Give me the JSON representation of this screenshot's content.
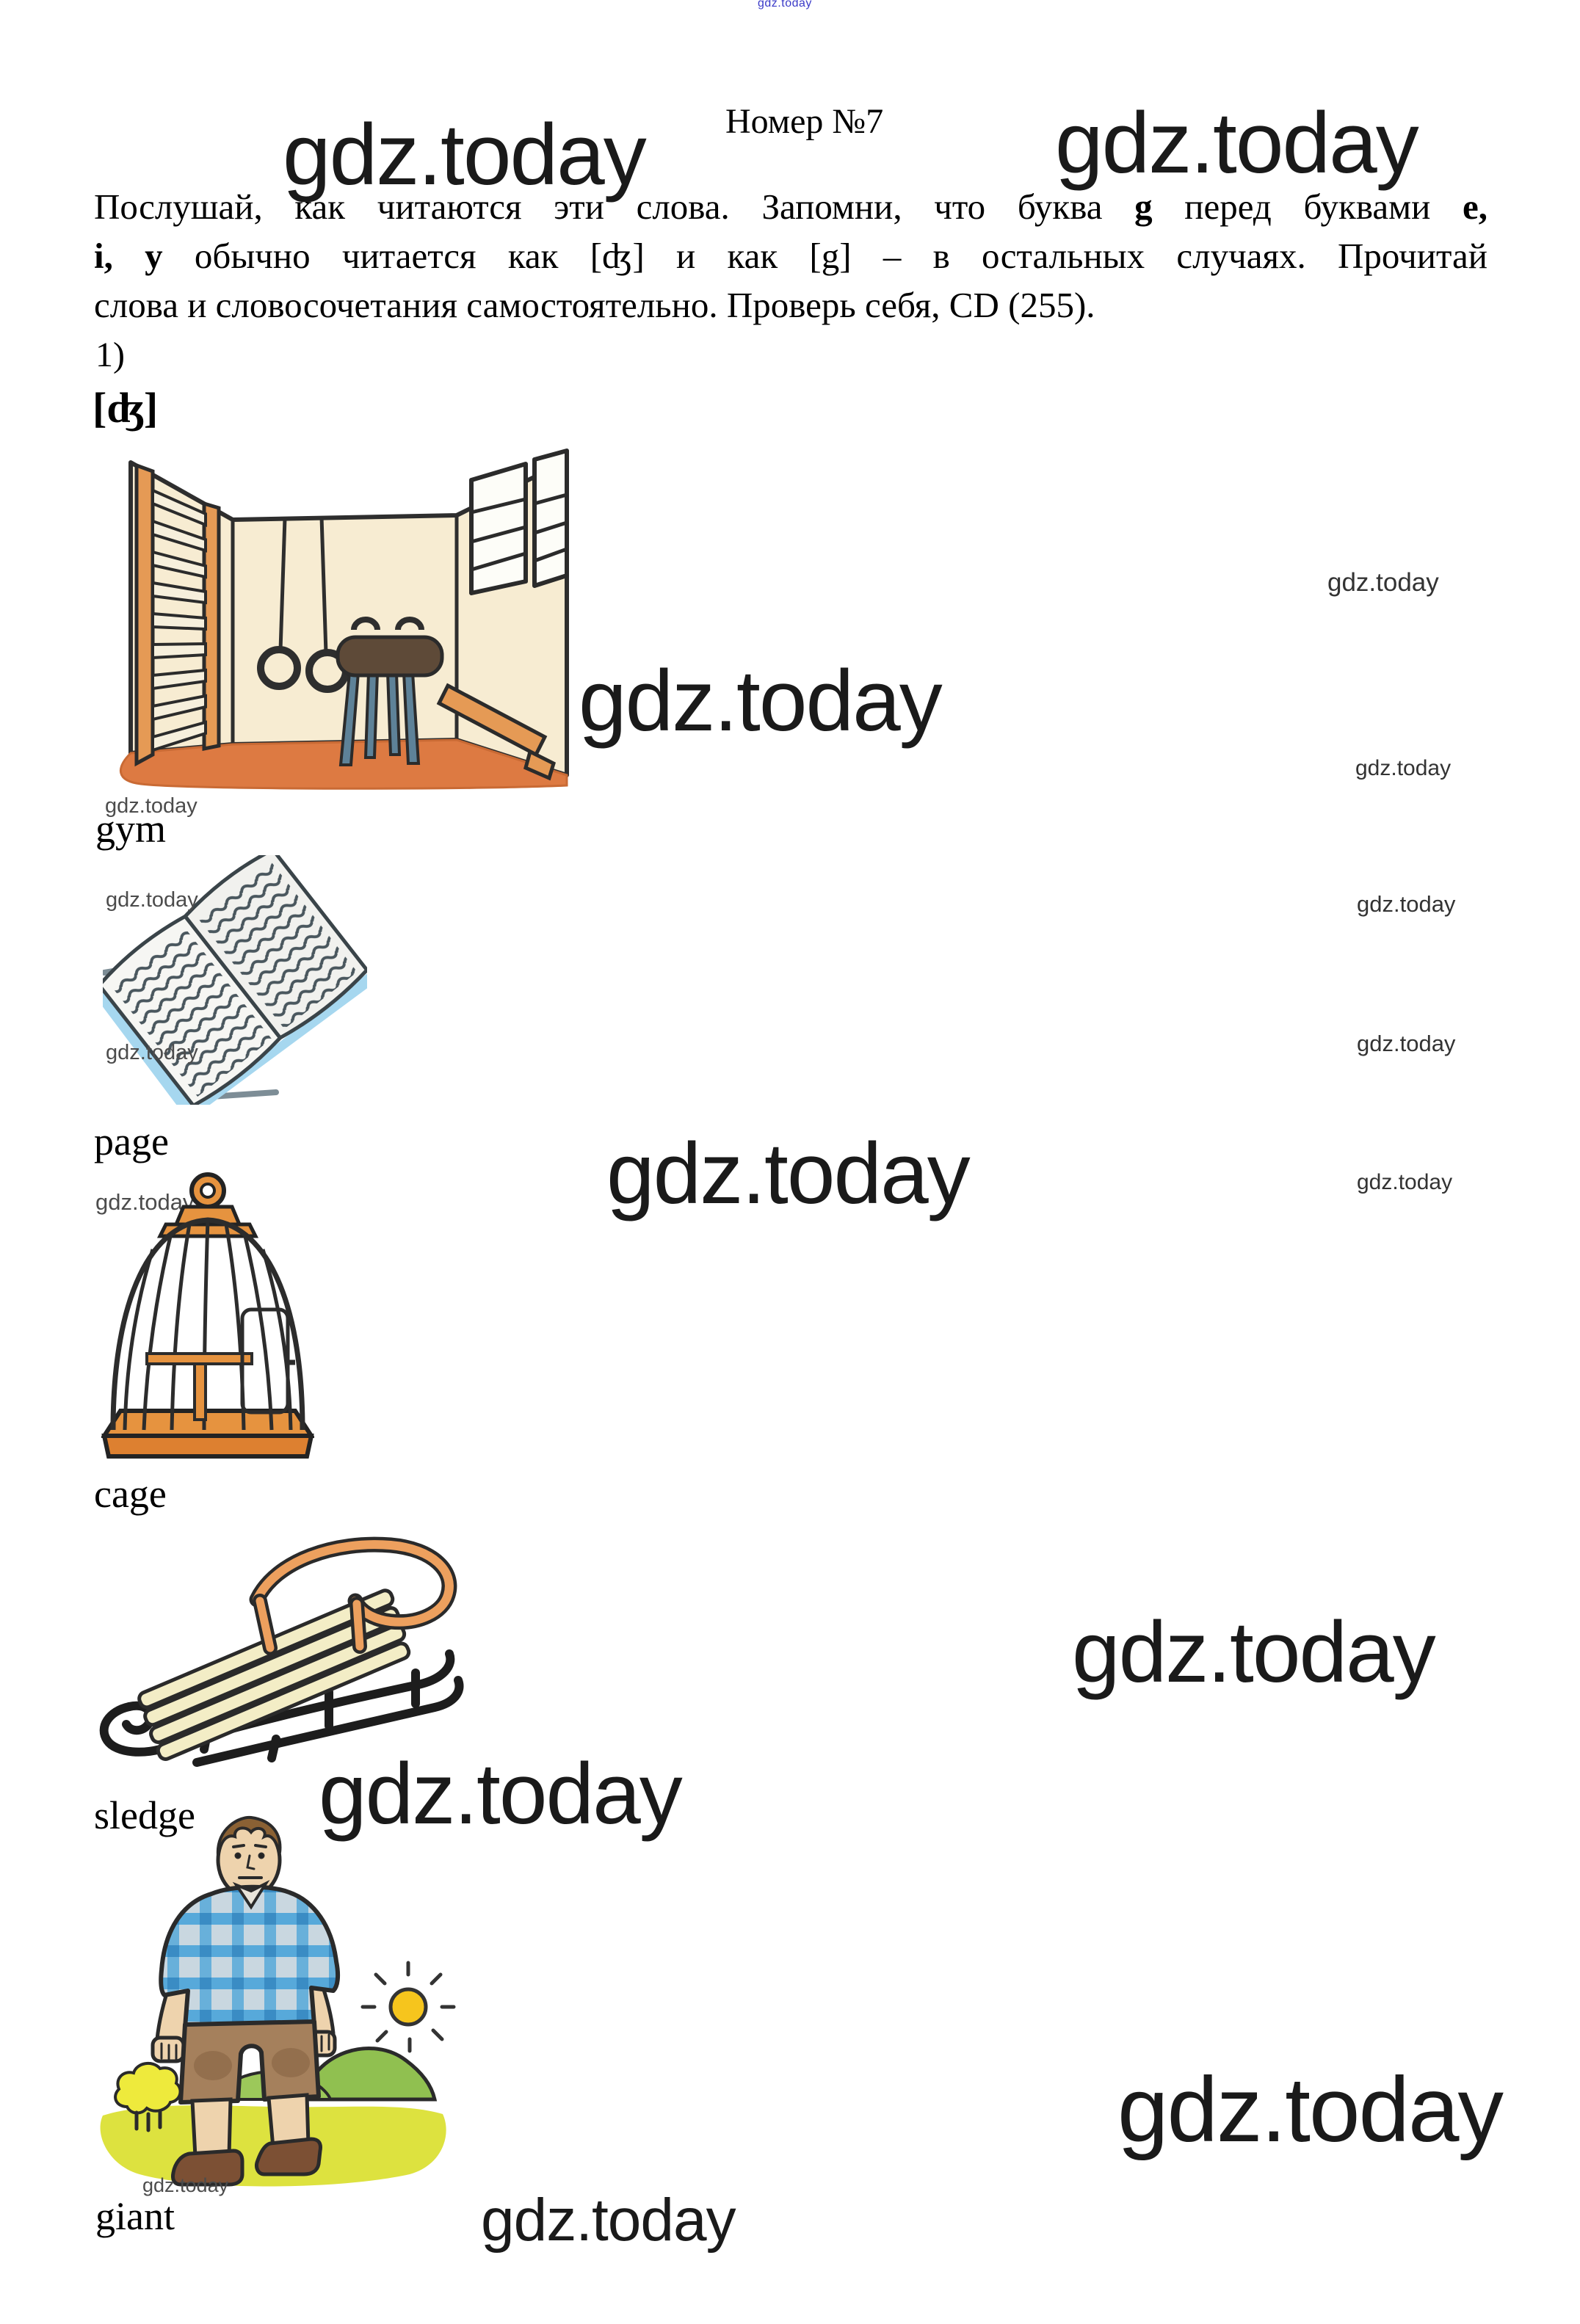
{
  "page": {
    "title": "Номер №7",
    "item_marker": "1)",
    "phonetic_label": "[ʤ]"
  },
  "watermark": {
    "text": "gdz.today"
  },
  "instructions": {
    "line1_a": "Послушай, как читаются эти слова. Запомни, что буква ",
    "line1_b": "g",
    "line1_c": " перед буквами ",
    "line1_d": "e,",
    "line2_a": "i, y",
    "line2_b": " обычно читается как [ʤ] и как [g] – в остальных случаях. Прочитай",
    "line3": "слова и словосочетания самостоятельно. Проверь себя, CD (255)."
  },
  "words": [
    {
      "label": "gym",
      "image": "gym-room"
    },
    {
      "label": "page",
      "image": "open-book"
    },
    {
      "label": "cage",
      "image": "birdcage"
    },
    {
      "label": "sledge",
      "image": "wooden-sledge"
    },
    {
      "label": "giant",
      "image": "giant-man"
    }
  ],
  "colors": {
    "watermark_dark": "#1a1a1a",
    "watermark_gray": "#4c4c4c",
    "watermark_blue": "#3b3bc8",
    "illustration_orange": "#e0823f",
    "illustration_blue": "#57a9da",
    "illustration_green": "#90c050",
    "illustration_yellow": "#f6c51d"
  }
}
